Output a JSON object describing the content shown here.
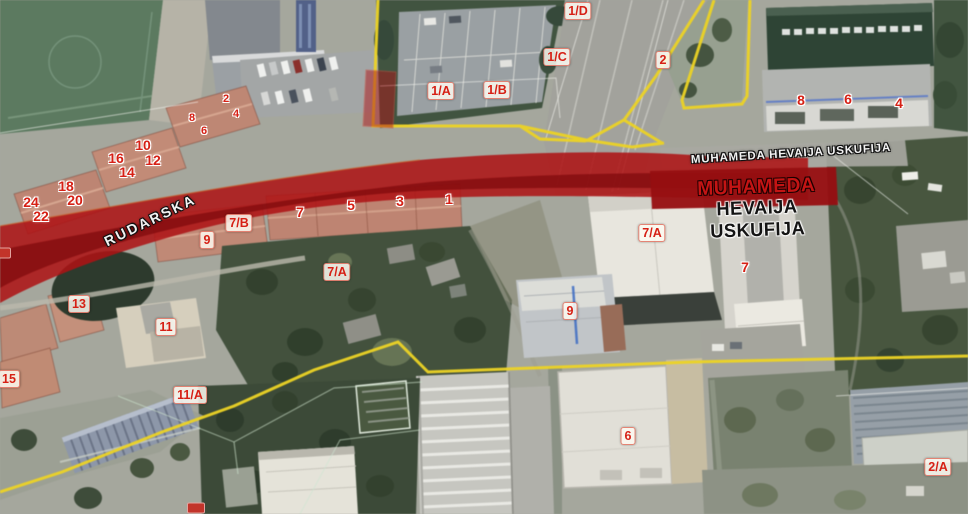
{
  "map": {
    "street_names": {
      "rudarska": "RUDARSKA",
      "muhameda": "MUHAMEDA HEVAIJA USKUFIJA"
    },
    "highlight_title": {
      "line1": "MUHAMEDA",
      "line2": "HEVAIJA",
      "line3": "USKUFIJA"
    },
    "markers": [
      {
        "text": "1/D",
        "x": 578,
        "y": 11,
        "style": "box"
      },
      {
        "text": "1/C",
        "x": 557,
        "y": 57,
        "style": "box"
      },
      {
        "text": "2",
        "x": 663,
        "y": 60,
        "style": "box"
      },
      {
        "text": "1/A",
        "x": 441,
        "y": 91,
        "style": "box"
      },
      {
        "text": "1/B",
        "x": 497,
        "y": 90,
        "style": "box"
      },
      {
        "text": "2",
        "x": 226,
        "y": 99,
        "style": "halo-sm"
      },
      {
        "text": "4",
        "x": 236,
        "y": 114,
        "style": "halo-sm"
      },
      {
        "text": "8",
        "x": 192,
        "y": 118,
        "style": "halo-sm"
      },
      {
        "text": "6",
        "x": 204,
        "y": 131,
        "style": "halo-sm"
      },
      {
        "text": "10",
        "x": 143,
        "y": 145,
        "style": "halo"
      },
      {
        "text": "12",
        "x": 153,
        "y": 160,
        "style": "halo"
      },
      {
        "text": "16",
        "x": 116,
        "y": 158,
        "style": "halo"
      },
      {
        "text": "14",
        "x": 127,
        "y": 172,
        "style": "halo"
      },
      {
        "text": "18",
        "x": 66,
        "y": 186,
        "style": "halo"
      },
      {
        "text": "20",
        "x": 75,
        "y": 200,
        "style": "halo"
      },
      {
        "text": "24",
        "x": 31,
        "y": 202,
        "style": "halo"
      },
      {
        "text": "22",
        "x": 41,
        "y": 216,
        "style": "halo"
      },
      {
        "text": "8",
        "x": 801,
        "y": 100,
        "style": "halo"
      },
      {
        "text": "6",
        "x": 848,
        "y": 99,
        "style": "halo"
      },
      {
        "text": "4",
        "x": 899,
        "y": 103,
        "style": "halo"
      },
      {
        "text": "7/B",
        "x": 239,
        "y": 223,
        "style": "box"
      },
      {
        "text": "9",
        "x": 207,
        "y": 240,
        "style": "box"
      },
      {
        "text": "7",
        "x": 300,
        "y": 212,
        "style": "halo"
      },
      {
        "text": "5",
        "x": 351,
        "y": 205,
        "style": "halo"
      },
      {
        "text": "3",
        "x": 400,
        "y": 201,
        "style": "halo"
      },
      {
        "text": "1",
        "x": 449,
        "y": 199,
        "style": "halo"
      },
      {
        "text": "7/A",
        "x": 337,
        "y": 272,
        "style": "box"
      },
      {
        "text": "7/A",
        "x": 652,
        "y": 233,
        "style": "box"
      },
      {
        "text": "7",
        "x": 745,
        "y": 267,
        "style": "halo"
      },
      {
        "text": "9",
        "x": 570,
        "y": 311,
        "style": "box"
      },
      {
        "text": "13",
        "x": 79,
        "y": 304,
        "style": "box"
      },
      {
        "text": "11",
        "x": 166,
        "y": 327,
        "style": "box"
      },
      {
        "text": "15",
        "x": 9,
        "y": 379,
        "style": "box"
      },
      {
        "text": "11/A",
        "x": 190,
        "y": 395,
        "style": "box"
      },
      {
        "text": "6",
        "x": 628,
        "y": 436,
        "style": "box"
      },
      {
        "text": "2/A",
        "x": 938,
        "y": 467,
        "style": "box"
      },
      {
        "text": "",
        "x": 2,
        "y": 253,
        "style": "partial"
      },
      {
        "text": "",
        "x": 196,
        "y": 508,
        "style": "partial"
      }
    ],
    "colors": {
      "corridor_red": "#b41114",
      "corridor_core_red": "#840a0c",
      "parcel_line_yellow": "#eed31c",
      "marker_red": "#d62015",
      "street_text_white": "#f2f2f2",
      "title_red": "#c41414",
      "title_black": "#141414",
      "measure_blue": "#3a6cc8"
    }
  }
}
